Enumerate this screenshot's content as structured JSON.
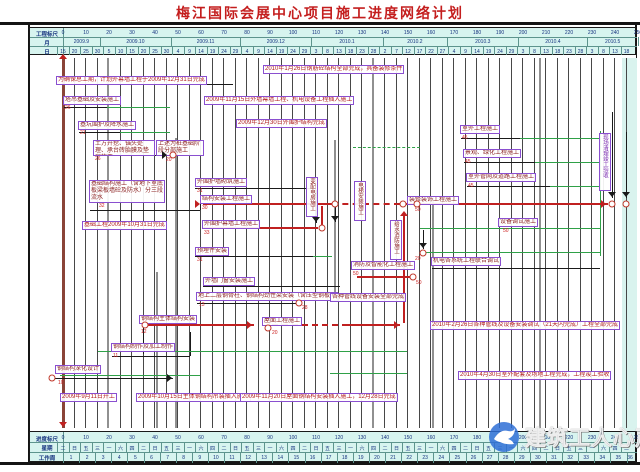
{
  "title": "梅江国际会展中心项目施工进度网络计划",
  "watermark": {
    "text": "建筑工人心声",
    "icon": "dove-globe-icon",
    "circle_color": "#2e6fd6"
  },
  "colors": {
    "critical": "#c02020",
    "float": "#2fa148",
    "task": "#1a1a1a",
    "box_border": "#8a4fd0",
    "table_bg": "#d7f4ef",
    "title": "#c41e1e",
    "start_line": "#8a4438"
  },
  "header": {
    "scale_label": "工程标尺",
    "month_label": "月",
    "day_label": "日",
    "scale_numbers": [
      "0",
      "10",
      "20",
      "30",
      "40",
      "50",
      "60",
      "70",
      "80",
      "90",
      "100",
      "110",
      "120",
      "130",
      "140",
      "150",
      "160",
      "170",
      "180",
      "190",
      "200",
      "210",
      "220",
      "230",
      "240",
      "250"
    ],
    "months": [
      {
        "label": "2009.9",
        "days": 16
      },
      {
        "label": "2009.10",
        "days": 31
      },
      {
        "label": "2009.11",
        "days": 30
      },
      {
        "label": "2009.12",
        "days": 31
      },
      {
        "label": "2010.1",
        "days": 31
      },
      {
        "label": "2010.2",
        "days": 28
      },
      {
        "label": "2010.3",
        "days": 31
      },
      {
        "label": "2010.4",
        "days": 30
      },
      {
        "label": "2010.5",
        "days": 22
      }
    ],
    "day_ticks": [
      "15",
      "20",
      "25",
      "30",
      "5",
      "10",
      "15",
      "20",
      "25",
      "30",
      "4",
      "9",
      "14",
      "19",
      "24",
      "29",
      "4",
      "9",
      "14",
      "19",
      "24",
      "29",
      "3",
      "8",
      "13",
      "18",
      "23",
      "28",
      "2",
      "7",
      "12",
      "17",
      "22",
      "27",
      "4",
      "9",
      "14",
      "19",
      "24",
      "29",
      "3",
      "8",
      "13",
      "18",
      "23",
      "28",
      "3",
      "8",
      "13",
      "18"
    ]
  },
  "footer": {
    "scale_label": "进度标尺",
    "week_label": "星期",
    "workweek_label": "工作周",
    "scale_numbers": [
      "0",
      "10",
      "20",
      "30",
      "40",
      "50",
      "60",
      "70",
      "80",
      "90",
      "100",
      "110",
      "120",
      "130",
      "140",
      "150",
      "160",
      "170",
      "180",
      "190",
      "200",
      "210",
      "220",
      "230",
      "240",
      "250"
    ],
    "weekday_pattern": [
      "二",
      "日",
      "五",
      "三",
      "一",
      "六",
      "四"
    ],
    "week_count": 36
  },
  "chart_data": {
    "type": "gantt-network",
    "title": "梅江国际会展中心项目施工进度网络计划",
    "time_origin": "2009-09-15",
    "unit": "days",
    "xlim": [
      0,
      250
    ],
    "tasks": [
      {
        "name": "塔吊基础及安装施工",
        "node": "26",
        "start": 1,
        "end": 20,
        "float_end": 47
      },
      {
        "name": "基坑围护及降水施工",
        "node": "21",
        "start": 7,
        "end": 25,
        "float_end": 47
      },
      {
        "name": "土方开挖、锚头处理、承台砖胎膜及垫层施工（上述为桩基础阶段分部施工）",
        "node": "26",
        "start": 14,
        "end": 46
      },
      {
        "name": "基础结构施工（含地下室底板梁板墙砼及防水）分三段流水",
        "node": "32",
        "start": 12,
        "end": 60
      },
      {
        "name": "外围护墙砌筑施工",
        "node": "31",
        "start": 58,
        "end": 110
      },
      {
        "name": "结构安装工程施工",
        "node": "30",
        "start": 61,
        "end": 160,
        "critical": true
      },
      {
        "name": "外围护幕墙工程施工",
        "node": "33",
        "start": 61,
        "end": 111,
        "critical": true
      },
      {
        "name": "预埋件安装",
        "node": "31",
        "start": 58,
        "end": 109
      },
      {
        "name": "外墙门窗安装施工",
        "start": 61,
        "end": 121
      },
      {
        "name": "地上二层钢骨柱、钢结构劲性梁安装（含压型钢板）",
        "node": "13",
        "start": 59,
        "end": 102
      },
      {
        "name": "钢结构深化设计",
        "node": "10",
        "start": 0,
        "end": 50
      },
      {
        "name": "钢结构制作及加工制作",
        "node": "11",
        "start": 22,
        "end": 56
      },
      {
        "name": "钢结构主体结构安装",
        "node": "12",
        "start": 35,
        "end": 84,
        "critical": true
      },
      {
        "name": "屋面工程施工",
        "node": "20",
        "start": 91,
        "end": 148,
        "critical": true
      },
      {
        "name": "装修装饰工程施工",
        "node": "50",
        "start": 148,
        "end": 238,
        "critical": true
      },
      {
        "name": "设备调试施工",
        "node": "50",
        "start": 156,
        "end": 234
      },
      {
        "name": "机电各系统工程联合调试",
        "node": "20",
        "start": 161,
        "end": 234
      },
      {
        "name": "消防及智能化工程施工",
        "node": "50",
        "start": 128,
        "end": 151
      },
      {
        "name": "变配电房施工",
        "start": 107,
        "end": 118
      },
      {
        "name": "电梯安装施工",
        "start": 127,
        "end": 138
      },
      {
        "name": "给水消防施工",
        "start": 143,
        "end": 158
      },
      {
        "name": "各种管线设备安装全部完成",
        "start": 117,
        "end": 150
      },
      {
        "name": "室外工程施工",
        "node": "45",
        "start": 173,
        "end": 199,
        "float_end": 234
      },
      {
        "name": "景观、绿化工程施工",
        "node": "45",
        "start": 175,
        "end": 206,
        "float_end": 234
      },
      {
        "name": "室外管网及道路工程施工",
        "node": "45",
        "start": 176,
        "end": 212,
        "float_end": 234
      },
      {
        "name": "现场清理竣工验收",
        "start": 234,
        "end": 250,
        "critical": true
      }
    ],
    "milestones": [
      "为确保总工期，计划外幕墙工程于2009年12月31日完成",
      "2010年1月26日钢筋砼结构全部完成，具备装修条件",
      "2009年11月15日外墙幕墙工程、机电设备工程插入施工",
      "2009年12月30日外围护结构完成",
      "基础工程2009年10月31日完成",
      "2010年2月26日各种管线及设备安装调试（21天内完成）工程全部完成",
      "2010年4月30日室外配套及场地工程完成，工程竣工验收",
      "2009年9月11日开工",
      "2009年10月15日主体钢结构吊装插入施工",
      "2009年11月20日屋面钢结构安装插入施工，12月28日完成"
    ]
  },
  "elements": {
    "bands": [
      {
        "x": 592,
        "y": 3,
        "w": 15,
        "h": 373
      }
    ],
    "vspecial": [
      {
        "x": 63,
        "y1": 57,
        "y2": 428,
        "w": 3,
        "c": "#8a4438"
      },
      {
        "x": 108,
        "y1": 58,
        "y2": 428,
        "w": 2,
        "c": "#909090"
      },
      {
        "x": 157,
        "y1": 272,
        "y2": 428,
        "w": 2,
        "c": "#909090"
      },
      {
        "x": 176,
        "y1": 138,
        "y2": 428,
        "w": 2,
        "c": "#909090"
      },
      {
        "x": 335,
        "y1": 140,
        "y2": 302,
        "w": 2,
        "c": "#909090"
      },
      {
        "x": 373,
        "y1": 58,
        "y2": 428,
        "w": 2,
        "c": "#909090"
      },
      {
        "x": 433,
        "y1": 196,
        "y2": 428,
        "w": 2,
        "c": "#909090"
      },
      {
        "x": 540,
        "y1": 58,
        "y2": 428,
        "w": 2,
        "c": "#909090"
      },
      {
        "x": 316,
        "y1": 190,
        "y2": 223,
        "w": 1,
        "c": "#1a1a1a"
      },
      {
        "x": 335,
        "y1": 206,
        "y2": 222,
        "w": 1,
        "c": "#1a1a1a"
      },
      {
        "x": 423,
        "y1": 230,
        "y2": 249,
        "w": 1,
        "c": "#1a1a1a"
      },
      {
        "x": 612,
        "y1": 112,
        "y2": 198,
        "w": 1,
        "c": "#1a1a1a"
      },
      {
        "x": 626,
        "y1": 132,
        "y2": 198,
        "w": 1,
        "c": "#1a1a1a"
      },
      {
        "x": 200,
        "y1": 204,
        "y2": 210,
        "w": 1,
        "c": "#1a1a1a"
      },
      {
        "x": 190,
        "y1": 332,
        "y2": 356,
        "w": 1,
        "c": "#1a1a1a"
      },
      {
        "x": 143,
        "y1": 328,
        "y2": 354,
        "w": 1,
        "c": "#1a1a1a"
      },
      {
        "x": 404,
        "y1": 213,
        "y2": 323,
        "w": 1.5,
        "c": "#c02020"
      },
      {
        "x": 322,
        "y1": 206,
        "y2": 225,
        "w": 1.5,
        "c": "#c02020"
      },
      {
        "x": 600,
        "y1": 131,
        "y2": 256,
        "w": 1,
        "c": "#2fa148"
      }
    ],
    "hlines": [
      {
        "y": 84,
        "x1": 64,
        "x2": 233,
        "c": "#1a1a1a",
        "w": 1
      },
      {
        "y": 107,
        "x1": 64,
        "x2": 107,
        "c": "#1a1a1a",
        "w": 1
      },
      {
        "y": 132,
        "x1": 79,
        "x2": 120,
        "c": "#1a1a1a",
        "w": 1
      },
      {
        "y": 155,
        "x1": 94,
        "x2": 167,
        "c": "#1a1a1a",
        "w": 1
      },
      {
        "y": 188,
        "x1": 195,
        "x2": 316,
        "c": "#1a1a1a",
        "w": 1
      },
      {
        "y": 210,
        "x1": 90,
        "x2": 200,
        "c": "#1a1a1a",
        "w": 1
      },
      {
        "y": 256,
        "x1": 195,
        "x2": 313,
        "c": "#1a1a1a",
        "w": 1
      },
      {
        "y": 286,
        "x1": 203,
        "x2": 340,
        "c": "#1a1a1a",
        "w": 1
      },
      {
        "y": 303,
        "x1": 197,
        "x2": 296,
        "c": "#1a1a1a",
        "w": 1
      },
      {
        "y": 356,
        "x1": 112,
        "x2": 190,
        "c": "#1a1a1a",
        "w": 1
      },
      {
        "y": 378,
        "x1": 55,
        "x2": 173,
        "c": "#1a1a1a",
        "w": 1
      },
      {
        "y": 268,
        "x1": 432,
        "x2": 600,
        "c": "#1a1a1a",
        "w": 1
      },
      {
        "y": 138,
        "x1": 461,
        "x2": 520,
        "c": "#1a1a1a",
        "w": 1
      },
      {
        "y": 162,
        "x1": 464,
        "x2": 535,
        "c": "#1a1a1a",
        "w": 1
      },
      {
        "y": 186,
        "x1": 467,
        "x2": 550,
        "c": "#1a1a1a",
        "w": 1
      },
      {
        "y": 107,
        "x1": 107,
        "x2": 170,
        "c": "#2fa148",
        "w": 1
      },
      {
        "y": 132,
        "x1": 120,
        "x2": 170,
        "c": "#2fa148",
        "w": 1
      },
      {
        "y": 147,
        "x1": 353,
        "x2": 420,
        "c": "#2fa148",
        "w": 1,
        "dash": 1
      },
      {
        "y": 138,
        "x1": 520,
        "x2": 600,
        "c": "#2fa148",
        "w": 1
      },
      {
        "y": 162,
        "x1": 535,
        "x2": 600,
        "c": "#2fa148",
        "w": 1
      },
      {
        "y": 186,
        "x1": 550,
        "x2": 600,
        "c": "#2fa148",
        "w": 1
      },
      {
        "y": 228,
        "x1": 420,
        "x2": 600,
        "c": "#2fa148",
        "w": 1
      },
      {
        "y": 252,
        "x1": 420,
        "x2": 600,
        "c": "#2fa148",
        "w": 1
      },
      {
        "y": 256,
        "x1": 313,
        "x2": 332,
        "c": "#2fa148",
        "w": 1
      },
      {
        "y": 351,
        "x1": 98,
        "x2": 407,
        "c": "#2fa148",
        "w": 1
      },
      {
        "y": 375,
        "x1": 60,
        "x2": 200,
        "c": "#2fa148",
        "w": 1
      },
      {
        "y": 373,
        "x1": 330,
        "x2": 407,
        "c": "#2fa148",
        "w": 1
      },
      {
        "y": 204,
        "x1": 203,
        "x2": 332,
        "c": "#c02020",
        "w": 2
      },
      {
        "y": 204,
        "x1": 332,
        "x2": 400,
        "c": "#c02020",
        "w": 2,
        "dash": 1
      },
      {
        "y": 204,
        "x1": 400,
        "x2": 608,
        "c": "#c02020",
        "w": 2
      },
      {
        "y": 228,
        "x1": 203,
        "x2": 318,
        "c": "#c02020",
        "w": 2
      },
      {
        "y": 277,
        "x1": 357,
        "x2": 410,
        "c": "#c02020",
        "w": 2
      },
      {
        "y": 325,
        "x1": 143,
        "x2": 254,
        "c": "#c02020",
        "w": 2
      },
      {
        "y": 325,
        "x1": 272,
        "x2": 348,
        "c": "#c02020",
        "w": 2,
        "dash": 1
      },
      {
        "y": 325,
        "x1": 348,
        "x2": 400,
        "c": "#c02020",
        "w": 2
      }
    ],
    "boxes": [
      {
        "x": 56,
        "y": 76,
        "t": "为确保总工期，计划外幕墙工程于2009年12月31日完成",
        "cls": "a nw"
      },
      {
        "x": 263,
        "y": 65,
        "t": "2010年1月26日钢筋砼结构全部完成，具备装修条件",
        "cls": "a nw"
      },
      {
        "x": 204,
        "y": 96,
        "t": "2009年11月15日外墙幕墙工程、机电设备工程插入施工",
        "cls": "a nw"
      },
      {
        "x": 236,
        "y": 119,
        "t": "2009年12月30日外围护结构完成",
        "cls": "a nw"
      },
      {
        "x": 82,
        "y": 221,
        "t": "基础工程2009年10月31日完成",
        "cls": "a nw"
      },
      {
        "x": 430,
        "y": 321,
        "t": "2010年2月26日各种管线及设备安装调试（21天内完成）工程全部完成",
        "cls": "a nw"
      },
      {
        "x": 458,
        "y": 371,
        "t": "2010年4月30日室外配套及场地工程完成，工程竣工验收",
        "cls": "a nw"
      },
      {
        "x": 60,
        "y": 393,
        "t": "2009年9月11日开工",
        "cls": "a nw"
      },
      {
        "x": 136,
        "y": 393,
        "t": "2009年10月15日主体钢结构吊装插入施工",
        "cls": "a nw"
      },
      {
        "x": 240,
        "y": 393,
        "t": "2009年11月20日屋面钢结构安装插入施工，12月28日完成",
        "cls": "a nw"
      },
      {
        "x": 63,
        "y": 96,
        "t": "塔吊基础及安装施工",
        "cls": "nw",
        "num": "26",
        "nx": 65,
        "ny": 106
      },
      {
        "x": 78,
        "y": 121,
        "t": "基坑围护及降水施工",
        "cls": "nw",
        "num": "21",
        "nx": 80,
        "ny": 131
      },
      {
        "x": 93,
        "y": 140,
        "w": 62,
        "h": 16,
        "t": "土方开挖、锚头处理、承台砖胎膜及垫层施工",
        "num": "26",
        "nx": 95,
        "ny": 157
      },
      {
        "x": 156,
        "y": 140,
        "w": 48,
        "h": 16,
        "t": "上述为桩基础阶段分部施工"
      },
      {
        "x": 89,
        "y": 180,
        "w": 76,
        "h": 23,
        "t": "基础结构施工（含地下室底板梁板墙砼及防水）分三段流水",
        "num": "32",
        "nx": 99,
        "ny": 204
      },
      {
        "x": 195,
        "y": 178,
        "t": "外围护墙砌筑施工",
        "cls": "nw",
        "num": "31",
        "nx": 197,
        "ny": 189
      },
      {
        "x": 200,
        "y": 195,
        "t": "结构安装工程施工",
        "cls": "nw",
        "num": "30",
        "nx": 202,
        "ny": 206
      },
      {
        "x": 202,
        "y": 220,
        "t": "外围护幕墙工程施工",
        "cls": "nw",
        "num": "33",
        "nx": 204,
        "ny": 231
      },
      {
        "x": 195,
        "y": 247,
        "t": "预埋件安装",
        "cls": "nw",
        "num": "31",
        "nx": 197,
        "ny": 258
      },
      {
        "x": 203,
        "y": 277,
        "t": "外墙门窗安装施工",
        "cls": "nw"
      },
      {
        "x": 196,
        "y": 292,
        "t": "地上二层钢骨柱、钢结构劲性梁安装（含压型钢板）",
        "cls": "nw",
        "num": "13",
        "nx": 199,
        "ny": 303
      },
      {
        "x": 262,
        "y": 317,
        "t": "屋面工程施工",
        "cls": "nw"
      },
      {
        "x": 139,
        "y": 315,
        "t": "钢结构主体结构安装",
        "cls": "nw",
        "num": "12",
        "nx": 141,
        "ny": 330
      },
      {
        "x": 111,
        "y": 343,
        "t": "钢结构制作及加工制作",
        "cls": "nw",
        "num": "11",
        "nx": 113,
        "ny": 354
      },
      {
        "x": 55,
        "y": 365,
        "t": "钢结构深化设计",
        "cls": "nw",
        "num": "10",
        "nx": 58,
        "ny": 381
      },
      {
        "x": 407,
        "y": 196,
        "t": "装修装饰工程施工",
        "cls": "nw",
        "num": "50",
        "nx": 415,
        "ny": 208
      },
      {
        "x": 498,
        "y": 218,
        "t": "设备调试施工",
        "cls": "nw",
        "num": "50",
        "nx": 503,
        "ny": 229
      },
      {
        "x": 431,
        "y": 257,
        "t": "机电各系统工程联合调试",
        "cls": "nw"
      },
      {
        "x": 460,
        "y": 125,
        "t": "室外工程施工",
        "cls": "nw",
        "num": "45",
        "nx": 462,
        "ny": 136
      },
      {
        "x": 463,
        "y": 149,
        "t": "景观、绿化工程施工",
        "cls": "nw",
        "num": "45",
        "nx": 465,
        "ny": 160
      },
      {
        "x": 466,
        "y": 173,
        "t": "室外管网及道路工程施工",
        "cls": "nw",
        "num": "45",
        "nx": 468,
        "ny": 184
      },
      {
        "x": 351,
        "y": 261,
        "t": "消防及智能化工程施工",
        "cls": "nw",
        "num": "50",
        "nx": 353,
        "ny": 272
      },
      {
        "x": 330,
        "y": 293,
        "t": "各种管线设备安装全部完成",
        "cls": "nw"
      },
      {
        "x": 306,
        "y": 177,
        "h": 40,
        "t": "变配电房施工",
        "cls": "v"
      },
      {
        "x": 354,
        "y": 181,
        "h": 40,
        "t": "电梯安装施工",
        "cls": "v"
      },
      {
        "x": 390,
        "y": 220,
        "h": 40,
        "t": "给水消防施工",
        "cls": "v"
      },
      {
        "x": 599,
        "y": 133,
        "h": 58,
        "t": "现场清理竣工验收",
        "cls": "v vp"
      }
    ],
    "nodes": [
      {
        "x": 173,
        "y": 155
      },
      {
        "x": 322,
        "y": 228
      },
      {
        "x": 335,
        "y": 204
      },
      {
        "x": 403,
        "y": 204
      },
      {
        "x": 417,
        "y": 204
      },
      {
        "x": 612,
        "y": 204
      },
      {
        "x": 626,
        "y": 204
      },
      {
        "x": 145,
        "y": 325
      },
      {
        "x": 268,
        "y": 328
      },
      {
        "x": 299,
        "y": 303
      },
      {
        "x": 52,
        "y": 378
      },
      {
        "x": 423,
        "y": 253
      },
      {
        "x": 413,
        "y": 277
      }
    ],
    "texts": [
      {
        "x": 166,
        "y": 158,
        "t": "20"
      },
      {
        "x": 272,
        "y": 331,
        "t": "20"
      },
      {
        "x": 302,
        "y": 306,
        "t": "28"
      },
      {
        "x": 416,
        "y": 281,
        "t": "50"
      },
      {
        "x": 415,
        "y": 257,
        "t": "20"
      }
    ],
    "arrows": [
      {
        "x": 63,
        "y": 58,
        "d": "up",
        "c": "#c02020"
      },
      {
        "x": 63,
        "y": 426,
        "d": "down",
        "c": "#c02020"
      },
      {
        "x": 166,
        "y": 155,
        "d": "right",
        "c": "#1a1a1a"
      },
      {
        "x": 316,
        "y": 221,
        "d": "down",
        "c": "#1a1a1a"
      },
      {
        "x": 335,
        "y": 220,
        "d": "down",
        "c": "#1a1a1a"
      },
      {
        "x": 423,
        "y": 247,
        "d": "down",
        "c": "#1a1a1a"
      },
      {
        "x": 612,
        "y": 196,
        "d": "down",
        "c": "#1a1a1a"
      },
      {
        "x": 626,
        "y": 196,
        "d": "down",
        "c": "#1a1a1a"
      },
      {
        "x": 605,
        "y": 204,
        "d": "right",
        "c": "#c02020"
      },
      {
        "x": 251,
        "y": 325,
        "d": "right",
        "c": "#c02020"
      },
      {
        "x": 398,
        "y": 325,
        "d": "right",
        "c": "#c02020"
      },
      {
        "x": 404,
        "y": 215,
        "d": "up",
        "c": "#c02020"
      },
      {
        "x": 171,
        "y": 378,
        "d": "right",
        "c": "#1a1a1a"
      },
      {
        "x": 199,
        "y": 204,
        "d": "right",
        "c": "#c02020"
      }
    ]
  }
}
